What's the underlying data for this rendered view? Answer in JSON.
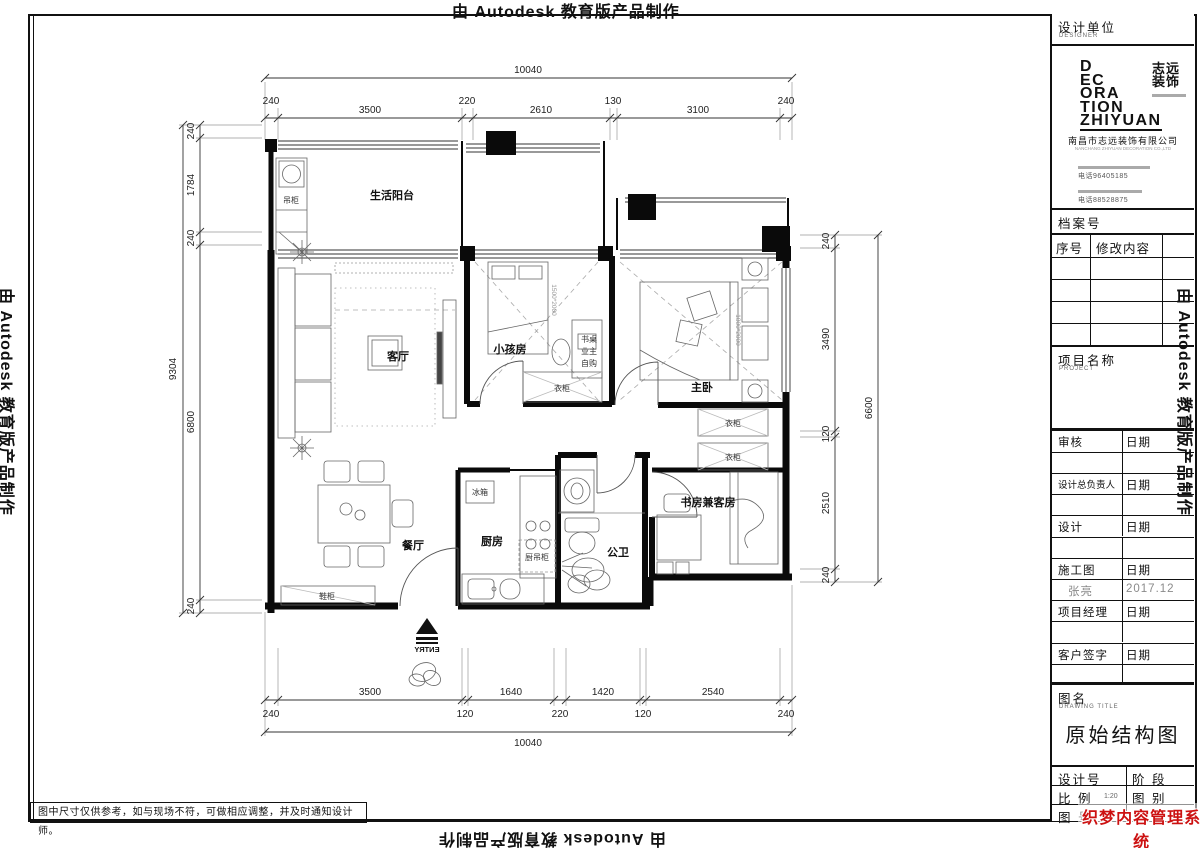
{
  "stamp": "由 Autodesk 教育版产品制作",
  "note": "图中尺寸仅供参考，如与现场不符，可做相应调整，并及时通知设计师。",
  "watermark": {
    "line1": "织梦内容管理系统",
    "line2": "DEDECMS.COM",
    "color": "#cc1111"
  },
  "title_block": {
    "design_unit": "设计单位",
    "designer_en": "DESIGNER",
    "logo_lines": {
      "l1": "D",
      "l2": "EC",
      "l3": "ORA",
      "l4": "TION",
      "l5": "ZHIYUAN"
    },
    "logo_cn1": "志远",
    "logo_cn2": "装饰",
    "company": "南昌市志远装饰有限公司",
    "company_en": "NANCHANG ZHIYUAN DECORATION CO.,LTD",
    "tel1": "电话96405185",
    "tel2": "电话88528875",
    "archive_no": "档案号",
    "seq": "序号",
    "revision": "修改内容",
    "project_name": "项目名称",
    "project_en": "PROJECT",
    "rows": [
      {
        "l": "审核",
        "r": "日期"
      },
      {
        "l": "设计总负责人",
        "r": "日期"
      },
      {
        "l": "设计",
        "r": "日期"
      },
      {
        "l": "施工图",
        "r": "日期"
      },
      {
        "l": "张亮",
        "r": "2017.12"
      },
      {
        "l": "项目经理",
        "r": "日期"
      },
      {
        "l": "客户签字",
        "r": "日期"
      }
    ],
    "drawing_name_label": "图名",
    "drawing_title_en": "DRAWING TITLE",
    "drawing_title": "原始结构图",
    "design_no": "设计号",
    "stage": "阶 段",
    "scale_label": "比 例",
    "scale_value": "1:20",
    "category": "图 别",
    "fig_no": "图 号"
  },
  "plan": {
    "rooms": {
      "balcony": "生活阳台",
      "living": "客厅",
      "kid": "小孩房",
      "master": "主卧",
      "dining": "餐厅",
      "kitchen": "厨房",
      "bath": "公卫",
      "study": "书房兼客房"
    },
    "furn": {
      "hang_cabinet": "吊柜",
      "desk_note1": "书桌",
      "desk_note2": "业主",
      "desk_note3": "自购",
      "wardrobe": "衣柜",
      "fridge": "冰箱",
      "kitchen_cabinet": "厨吊柜",
      "shoe": "鞋柜"
    },
    "beds": {
      "kid": "1500*2000",
      "master": "1800*2000"
    },
    "entry": "ENTRY"
  },
  "dims": {
    "top_total": "10040",
    "bottom_total": "10040",
    "left_total": "9304",
    "right_total": "6600",
    "top_chain": [
      "240",
      "3500",
      "220",
      "2610",
      "130",
      "3100",
      "240"
    ],
    "bottom_chain": [
      "240",
      "3500",
      "120",
      "1640",
      "220",
      "1420",
      "120",
      "2540",
      "240"
    ],
    "left_chain": [
      "240",
      "1784",
      "240",
      "6800",
      "240"
    ],
    "right_chain": [
      "240",
      "3490",
      "120",
      "2510",
      "240"
    ]
  }
}
